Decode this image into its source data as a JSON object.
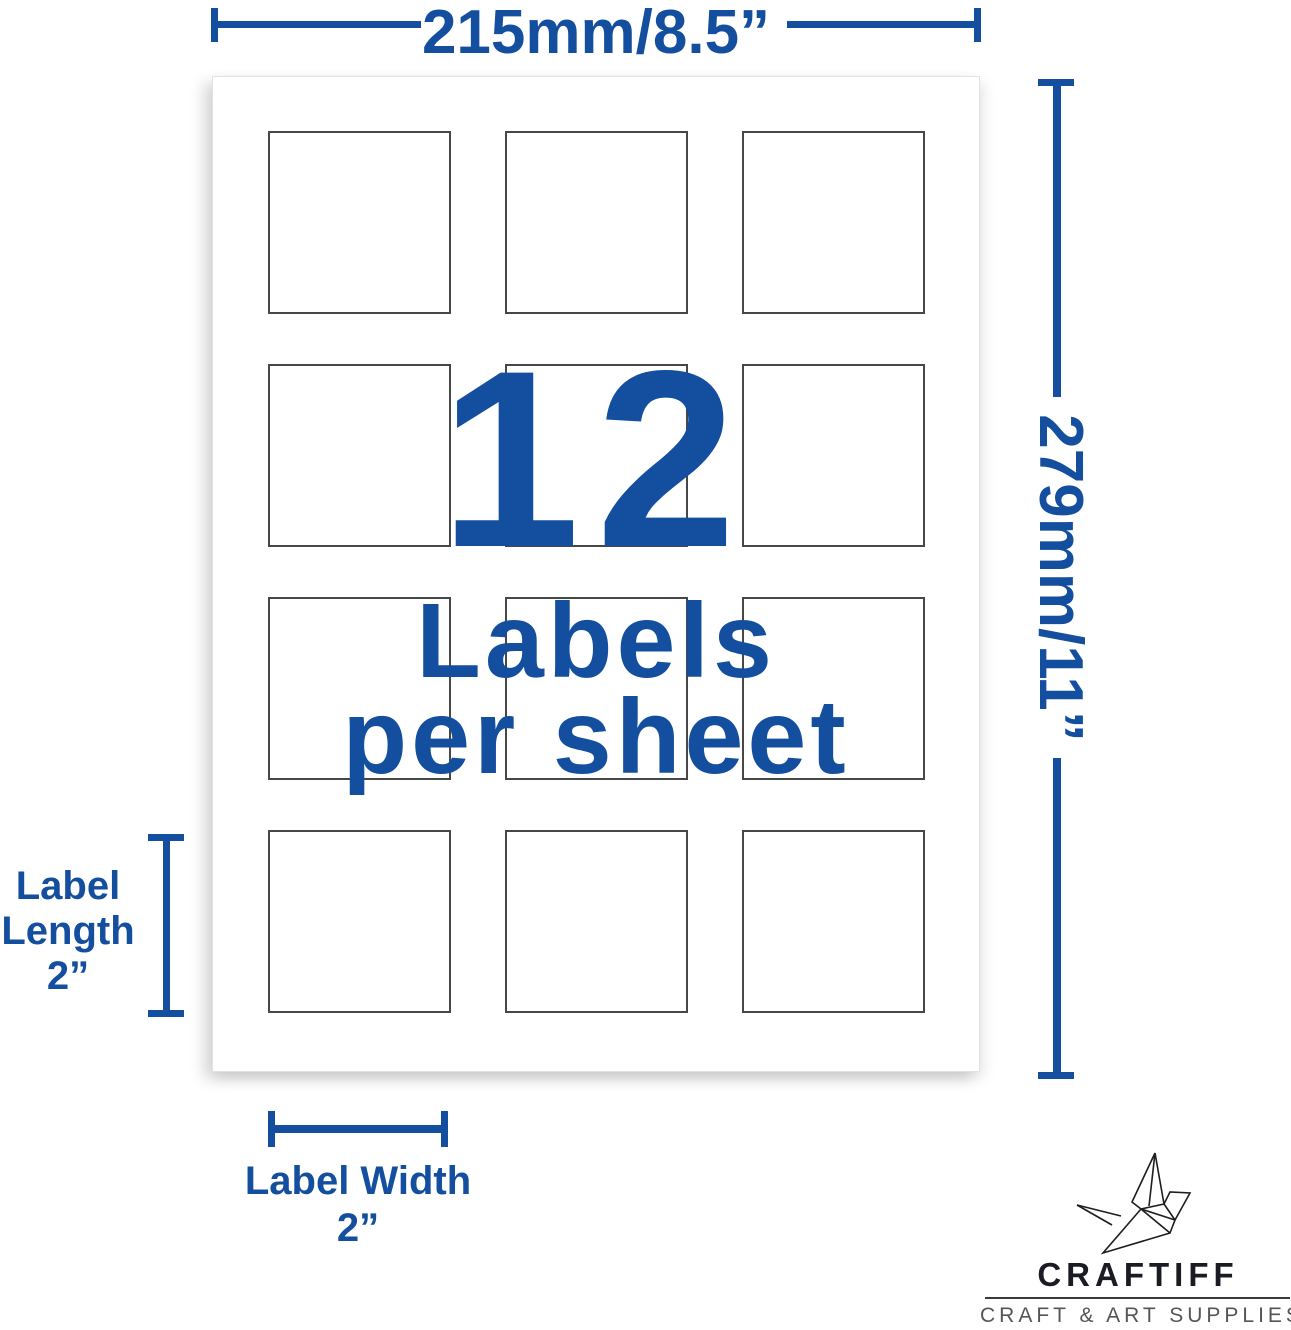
{
  "colors": {
    "accent_blue": "#134F9E",
    "logo_ink": "#1B1B24",
    "tagline_gray": "#555555"
  },
  "dimensions": {
    "sheet_width_label": "215mm/8.5”",
    "sheet_height_label": "279mm/11”",
    "label_length": {
      "line1": "Label",
      "line2": "Length",
      "line3": "2”"
    },
    "label_width": {
      "line1": "Label Width",
      "line2": "2”"
    }
  },
  "sheet": {
    "count": "12",
    "caption_line1": "Labels",
    "caption_line2": "per sheet",
    "labels_per_sheet": 12,
    "grid": {
      "rows": 4,
      "columns": 3
    }
  },
  "logo": {
    "brand": "CRAFTIFF",
    "tagline": "CRAFT & ART SUPPLIES",
    "icon": "origami-crane-icon"
  }
}
